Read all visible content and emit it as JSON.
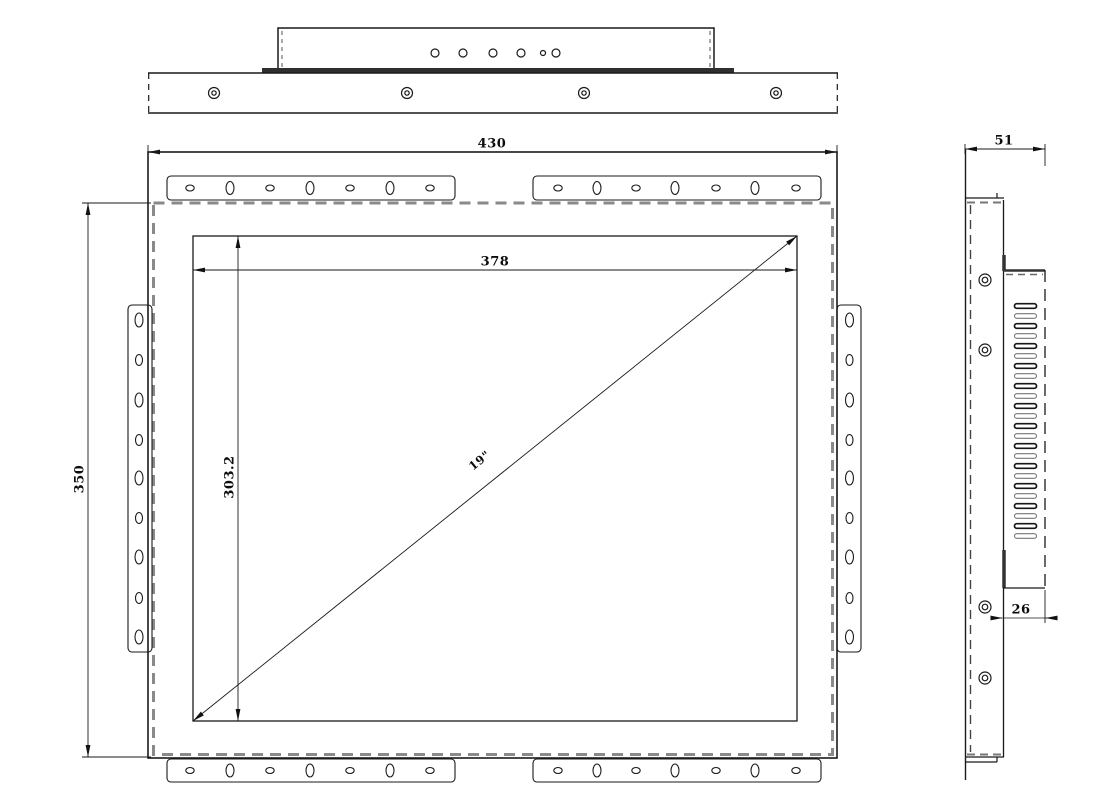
{
  "dimensions": {
    "overall_width": "430",
    "overall_height": "350",
    "active_area_width": "378",
    "active_area_height": "303.2",
    "diagonal": "19\"",
    "side_depth": "51",
    "rear_box_depth": "26"
  }
}
